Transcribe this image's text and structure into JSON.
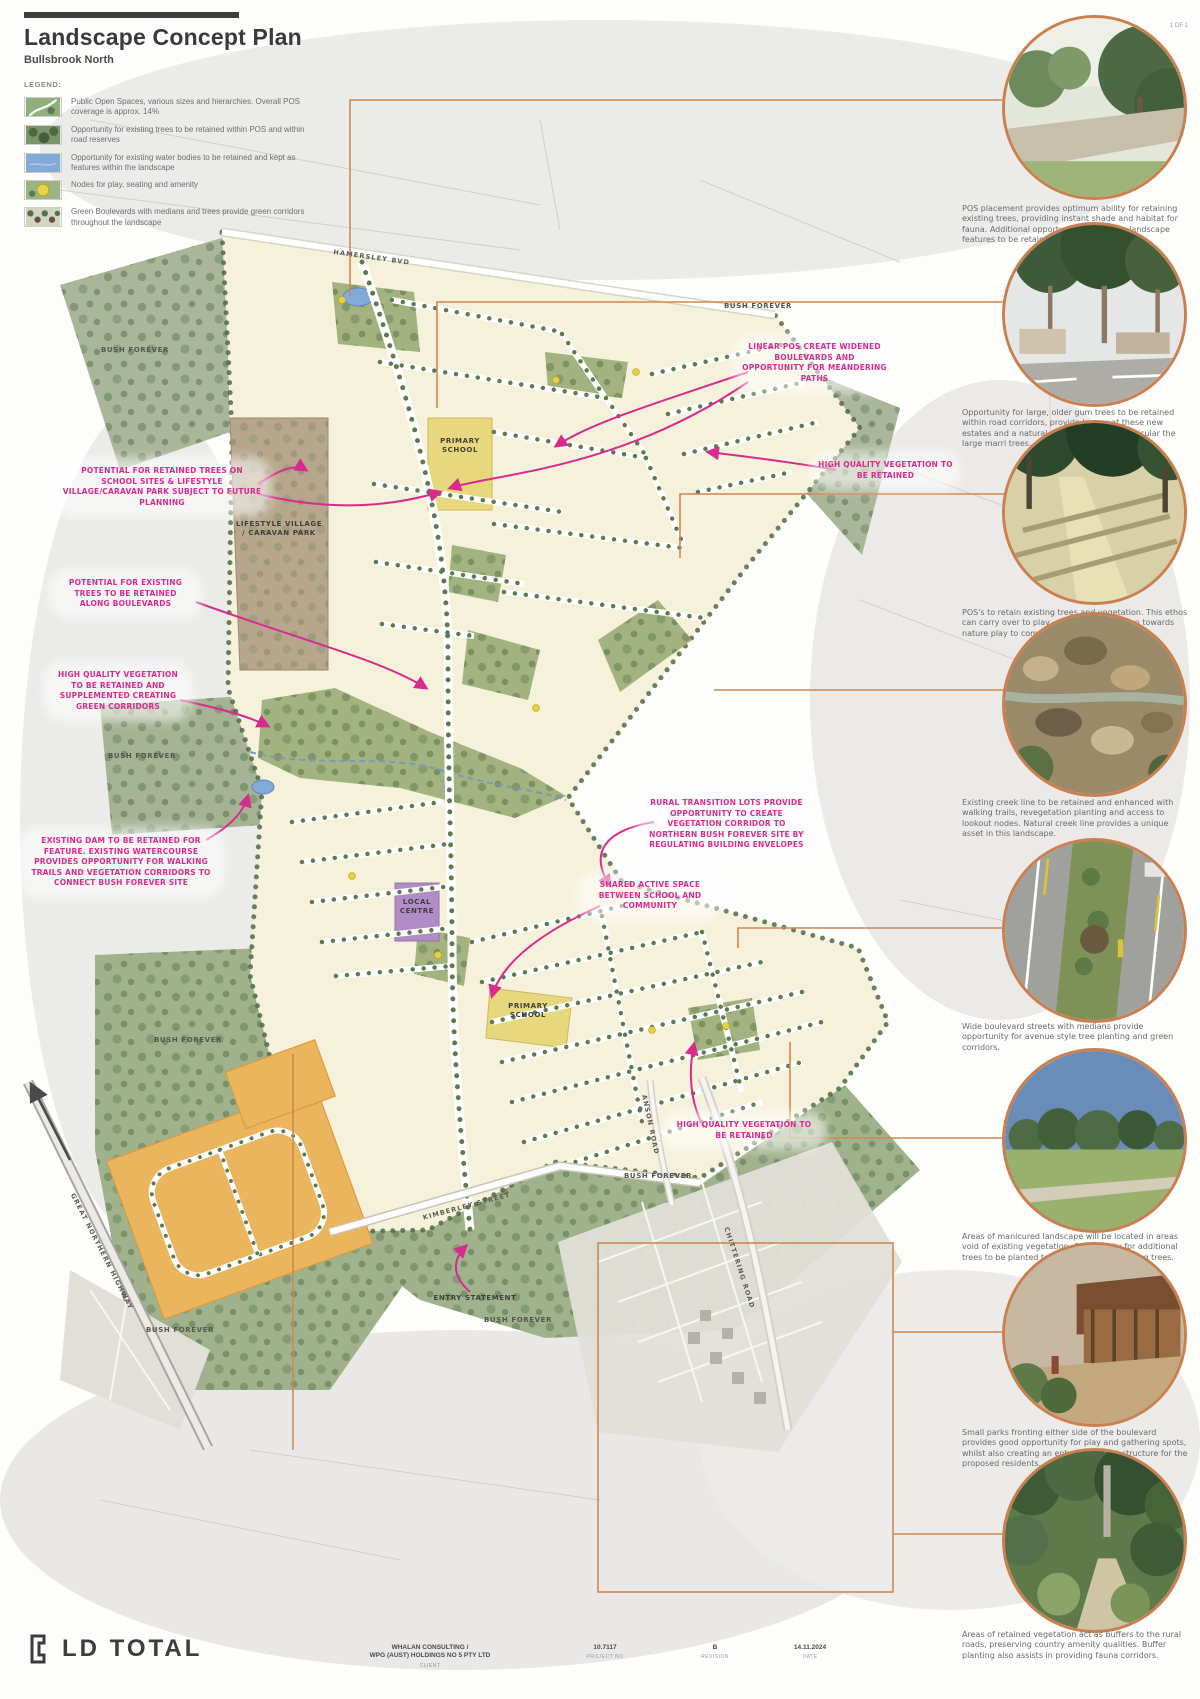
{
  "header": {
    "title": "Landscape Concept Plan",
    "subtitle": "Bullsbrook North",
    "legend_label": "LEGEND:"
  },
  "legend": [
    {
      "icon": "public-open-space-swatch",
      "text": "Public Open Spaces, various sizes and hierarchies. Overall POS coverage is approx. 14%"
    },
    {
      "icon": "retained-trees-swatch",
      "text": "Opportunity for existing trees to be retained within POS and within road reserves"
    },
    {
      "icon": "water-bodies-swatch",
      "text": "Opportunity for existing water bodies to be retained and kept as features within the landscape"
    },
    {
      "icon": "play-nodes-swatch",
      "text": "Nodes for play, seating and amenity"
    },
    {
      "icon": "green-boulevards-swatch",
      "text": "Green Boulevards with medians and trees provide green corridors throughout the landscape"
    }
  ],
  "map": {
    "labels": {
      "bush_forever": "BUSH FOREVER",
      "primary_school": "PRIMARY SCHOOL",
      "lifestyle_village": "LIFESTYLE VILLAGE / CARAVAN PARK",
      "local_centre": "LOCAL CENTRE",
      "entry_statement": "ENTRY STATEMENT"
    },
    "roads": {
      "north_boulevard": "HAMERSLEY BVD",
      "kimberley_street": "KIMBERLEY STREET",
      "chittering_road": "CHITTERING ROAD",
      "great_northern_highway": "GREAT NORTHERN HIGHWAY",
      "anson_road": "ANSON ROAD"
    },
    "annotations": [
      {
        "text": "POTENTIAL FOR RETAINED TREES ON SCHOOL SITES & LIFESTYLE VILLAGE/CARAVAN PARK SUBJECT TO FUTURE PLANNING"
      },
      {
        "text": "POTENTIAL FOR EXISTING TREES TO BE RETAINED ALONG BOULEVARDS"
      },
      {
        "text": "HIGH QUALITY VEGETATION TO BE RETAINED AND SUPPLEMENTED CREATING GREEN CORRIDORS"
      },
      {
        "text": "EXISTING DAM TO BE RETAINED FOR FEATURE. EXISTING WATERCOURSE PROVIDES OPPORTUNITY FOR WALKING TRAILS AND VEGETATION CORRIDORS TO CONNECT BUSH FOREVER SITE"
      },
      {
        "text": "LINEAR POS CREATE WIDENED BOULEVARDS AND OPPORTUNITY FOR MEANDERING PATHS"
      },
      {
        "text": "HIGH QUALITY VEGETATION TO BE RETAINED"
      },
      {
        "text": "RURAL TRANSITION LOTS PROVIDE OPPORTUNITY TO CREATE VEGETATION CORRIDOR TO NORTHERN BUSH FOREVER SITE BY REGULATING BUILDING ENVELOPES"
      },
      {
        "text": "SHARED ACTIVE SPACE BETWEEN SCHOOL AND COMMUNITY"
      },
      {
        "text": "HIGH QUALITY VEGETATION TO BE RETAINED"
      }
    ]
  },
  "photos": [
    {
      "name": "streetscape-render-photo",
      "caption": "POS placement provides optimum ability for retaining existing trees, providing instant shade and habitat for fauna. Additional opportunity for existing landscape features to be retained, for example the dam."
    },
    {
      "name": "retained-gum-trees-photo",
      "caption": "Opportunity for large, older gum trees to be retained within road corridors, provide legacy at these new estates and a natural commons feel, in particular the large marri trees."
    },
    {
      "name": "bush-nature-play-photo",
      "caption": "POS's to retain existing trees and vegetation. This ethos can carry over to play, and designs can lean towards nature play to compliment the bush feel."
    },
    {
      "name": "creek-line-photo",
      "caption": "Existing creek line to be retained and enhanced with walking trails, revegetation planting and access to lookout nodes. Natural creek line provides a unique asset in this landscape."
    },
    {
      "name": "boulevard-median-photo",
      "caption": "Wide boulevard streets with medians provide opportunity for avenue style tree planting and green corridors."
    },
    {
      "name": "manicured-park-photo",
      "caption": "Areas of manicured landscape will be located in areas void of existing vegetation. Opportunity for additional trees to be planted to supplement the existing trees."
    },
    {
      "name": "entry-park-photo",
      "caption": "Small parks fronting either side of the boulevard provides good opportunity for play and gathering spots, whilst also creating an entry statement structure for the proposed residents."
    },
    {
      "name": "vegetation-buffer-photo",
      "caption": "Areas of retained vegetation act as buffers to the rural roads, preserving country amenity qualities. Buffer planting also assists in providing fauna corridors."
    }
  ],
  "footer": {
    "logo": "LD TOTAL",
    "client_line1": "WHALAN CONSULTING /",
    "client_line2": "WPG (AUST) HOLDINGS NO 5 PTY LTD",
    "client_label": "CLIENT",
    "project_no": "10.7117",
    "project_no_label": "PROJECT NO",
    "revision": "B",
    "revision_label": "REVISION",
    "date": "14.11.2024",
    "date_label": "DATE",
    "page": "1 OF 1"
  },
  "colors": {
    "accent_pink": "#d92b8f",
    "accent_orange": "#c9804e",
    "site_cream": "#f5f1da",
    "pos_green": "#a2b37f",
    "bush_green": "#adb9a0",
    "water_blue": "#82aad8",
    "school_yellow": "#e7d87e",
    "centre_purple": "#b18cc6",
    "village_brown": "#b7a68c",
    "future_orange": "#ebb55e"
  }
}
